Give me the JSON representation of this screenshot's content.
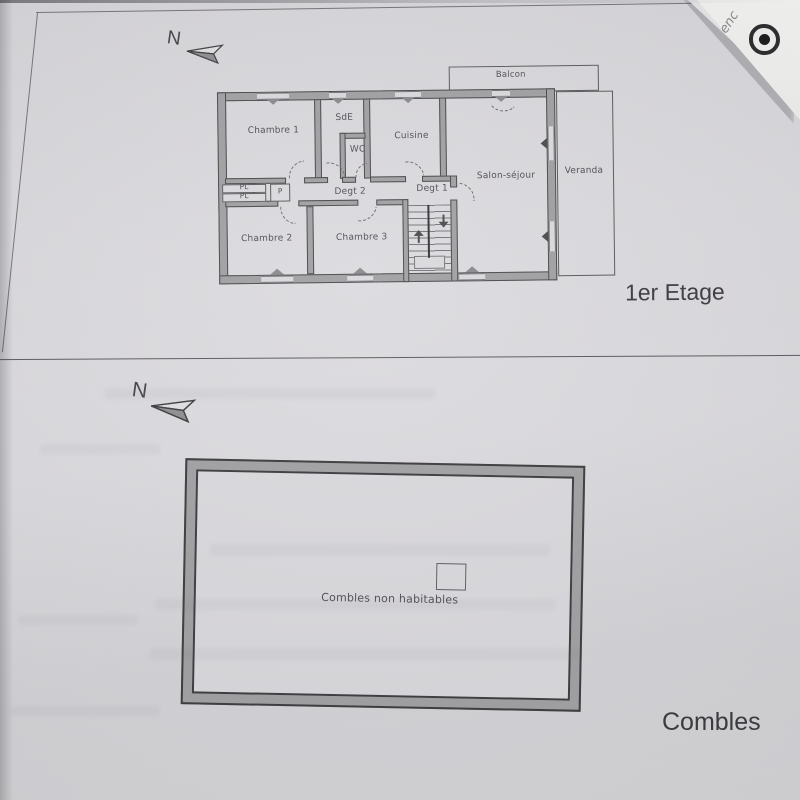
{
  "floor1": {
    "title": "1er Etage",
    "compass": "N",
    "rooms": {
      "chambre1": "Chambre 1",
      "sde": "SdE",
      "wc": "WC",
      "cuisine": "Cuisine",
      "balcon": "Balcon",
      "salon_sejour": "Salon-séjour",
      "veranda": "Veranda",
      "degagement2": "Degt 2",
      "degagement1": "Degt 1",
      "placard1": "PL",
      "placard2": "PL",
      "placard3": "P",
      "chambre2": "Chambre 2",
      "chambre3": "Chambre 3"
    }
  },
  "combles": {
    "title": "Combles",
    "compass": "N",
    "area_label": "Combles non habitables"
  },
  "overlay_card": {
    "partial_text": "enc"
  },
  "icons": {
    "north_arrow": "paper-plane arrow pointing left",
    "logo": "dark ring with center dot",
    "stair_up": "arrow-up",
    "stair_down": "arrow-down"
  },
  "colors": {
    "paper": "#d9d8dc",
    "wall_fill": "#a1a1a3",
    "wall_line": "#4b4b4d",
    "text": "#4d4d52"
  }
}
